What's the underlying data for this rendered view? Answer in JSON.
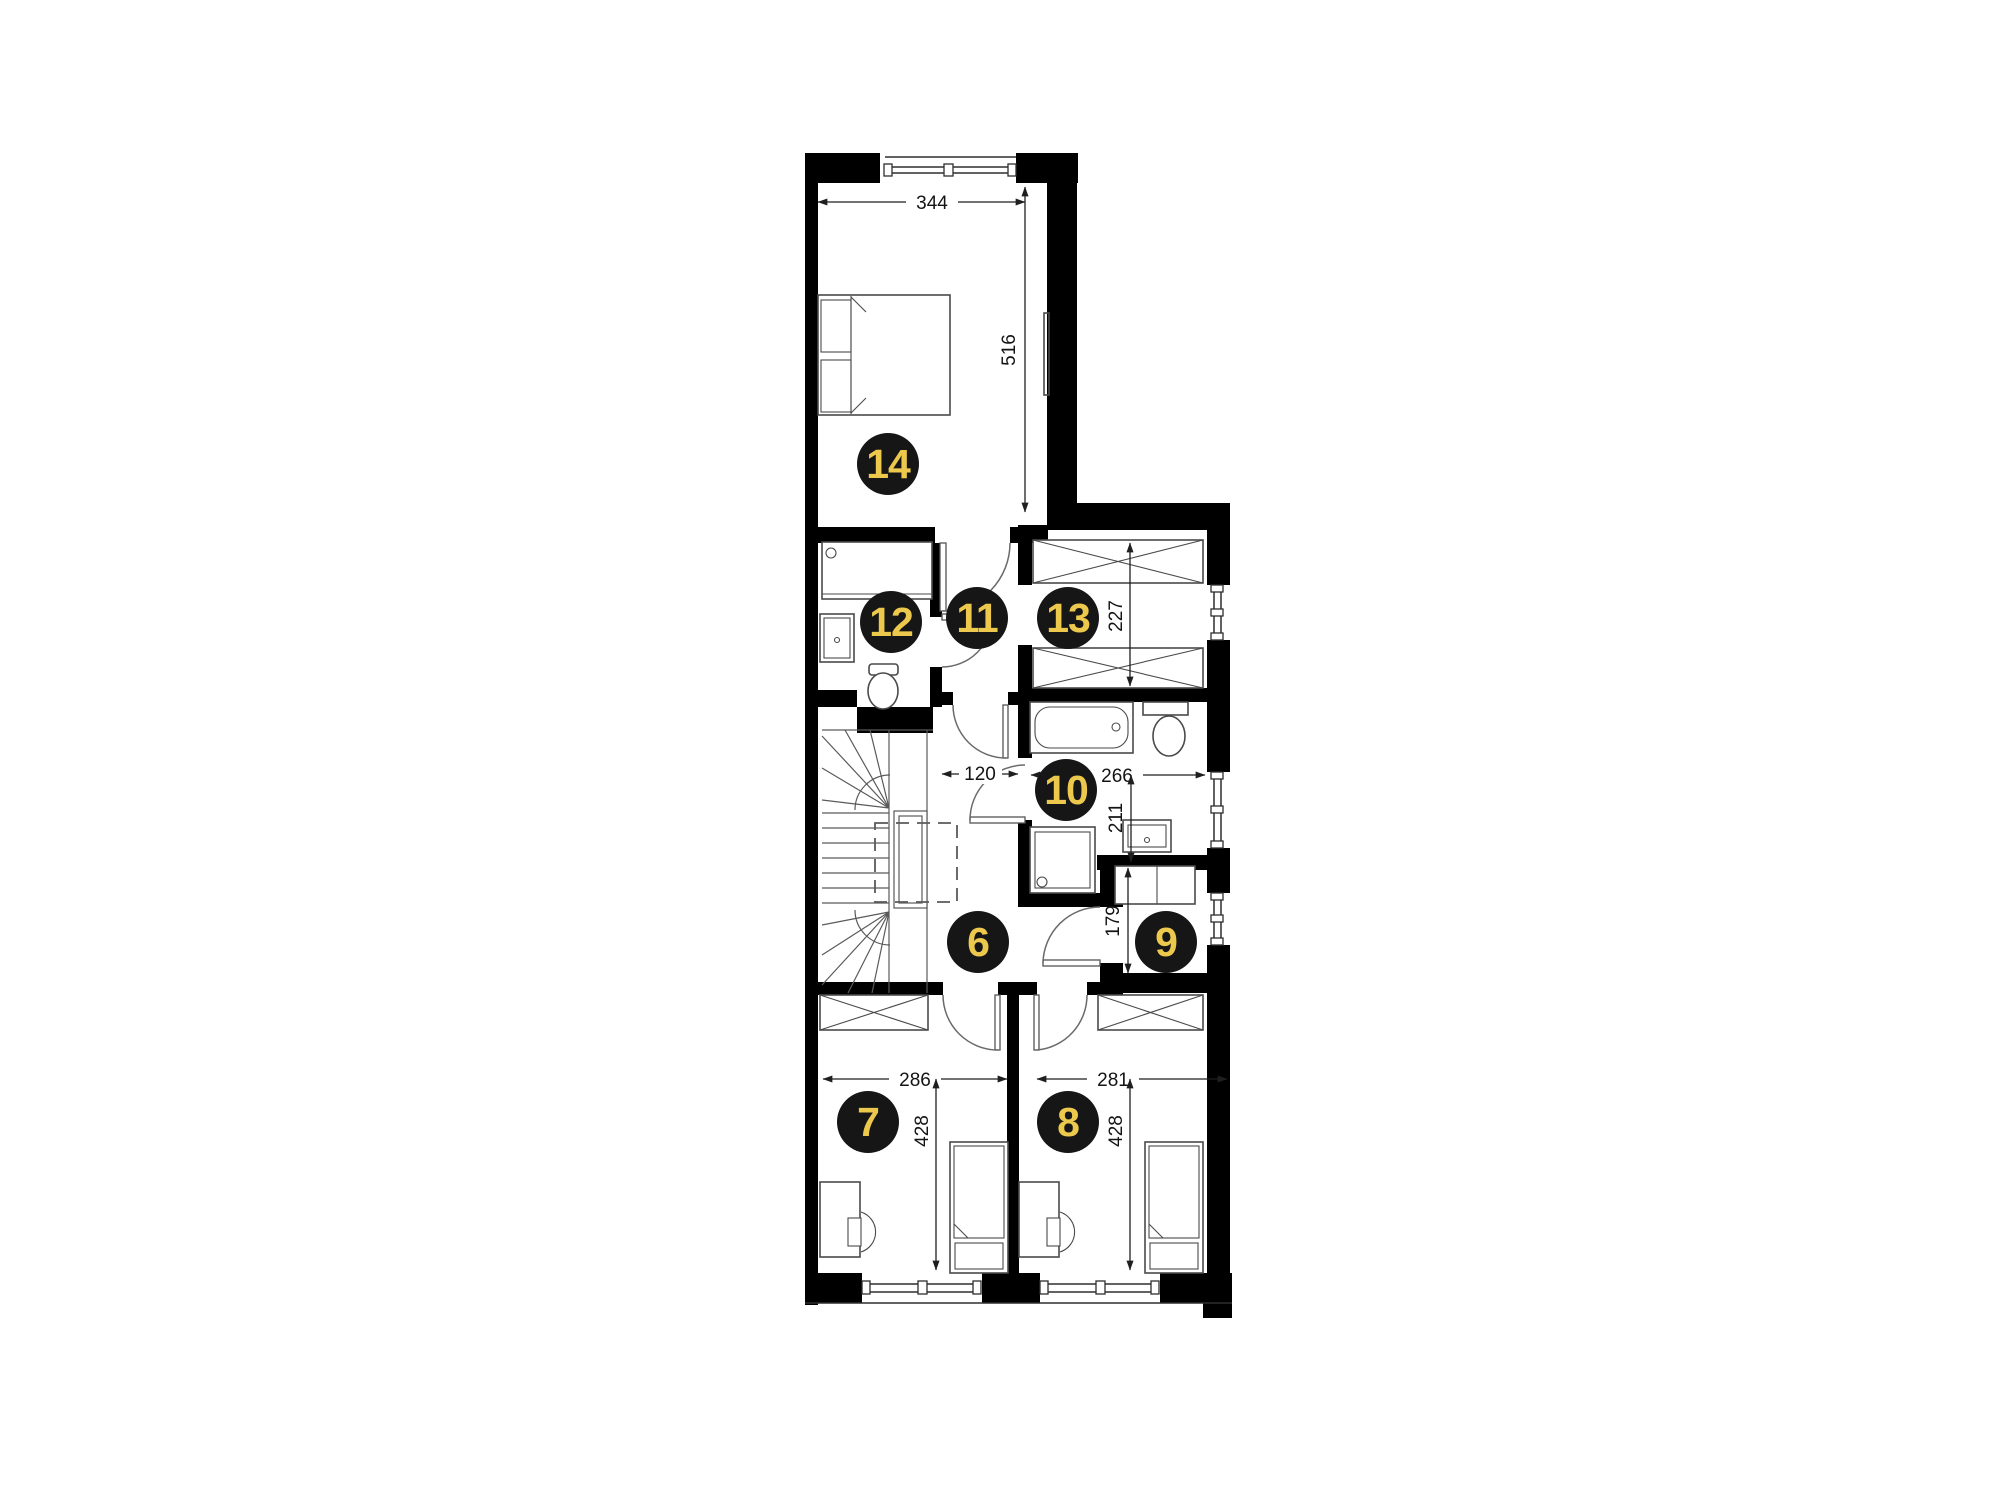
{
  "plan": {
    "badges": {
      "hall": "6",
      "bedroom_a": "7",
      "bedroom_b": "8",
      "closet_small": "9",
      "bathroom": "10",
      "landing": "11",
      "wc": "12",
      "closet": "13",
      "bedroom_master": "14"
    },
    "dimensions": {
      "master_width": "344",
      "master_depth": "516",
      "closet_depth": "227",
      "corridor_width": "120",
      "bath_width": "266",
      "bath_depth": "211",
      "closet_small_depth": "179",
      "bedroom_a_width": "286",
      "bedroom_a_depth": "428",
      "bedroom_b_width": "281",
      "bedroom_b_depth": "428"
    },
    "colors": {
      "wall": "#000000",
      "badge_bg": "#161616",
      "badge_number": "#ECC94D",
      "furniture_line": "#4a4a4a",
      "dimension_text": "#141414"
    }
  }
}
